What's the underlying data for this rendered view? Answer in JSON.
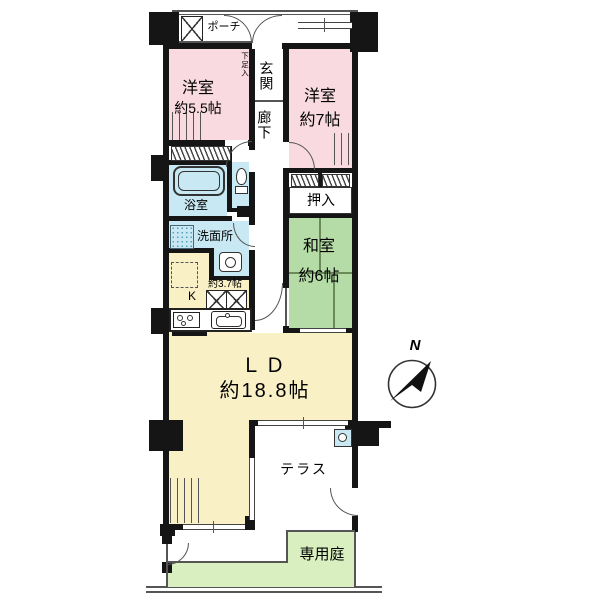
{
  "plan": {
    "type": "floor-plan",
    "palette": {
      "room_pink": "#F8DAE0",
      "tatami_green": "#B5DCA6",
      "garden_green": "#D9EFC0",
      "living_yellow": "#FAF0C6",
      "wet_blue": "#C8E9F3",
      "wall_black": "#151515"
    },
    "rooms": {
      "porch": {
        "label": "ポーチ"
      },
      "entrance": {
        "label": "玄関"
      },
      "shoe_closet": {
        "label": "下足入"
      },
      "hallway": {
        "label": "廊下"
      },
      "western_room_1": {
        "name": "洋室",
        "size": "約5.5帖"
      },
      "western_room_2": {
        "name": "洋室",
        "size": "約7帖"
      },
      "bathroom": {
        "label": "浴室"
      },
      "washroom": {
        "label": "洗面所"
      },
      "closet": {
        "label": "押入"
      },
      "japanese_room": {
        "name": "和室",
        "size": "約6帖"
      },
      "kitchen": {
        "label": "K",
        "size": "約3.7帖"
      },
      "living_dining": {
        "name": "ＬＤ",
        "size": "約18.8帖"
      },
      "terrace": {
        "label": "テラス"
      },
      "private_garden": {
        "label": "専用庭"
      }
    },
    "compass": {
      "label": "N"
    },
    "icons": {
      "meter_box": "x-box-icon",
      "kitchen_storage": "double-x-box-icon",
      "bathtub": "bathtub-icon",
      "toilet": "toilet-icon",
      "wash_basin": "basin-icon",
      "stove": "stove-icon",
      "kitchen_sink": "sink-icon",
      "washer": "washing-machine-icon",
      "fridge_space": "dashed-appliance-space",
      "north": "north-arrow-icon"
    }
  }
}
